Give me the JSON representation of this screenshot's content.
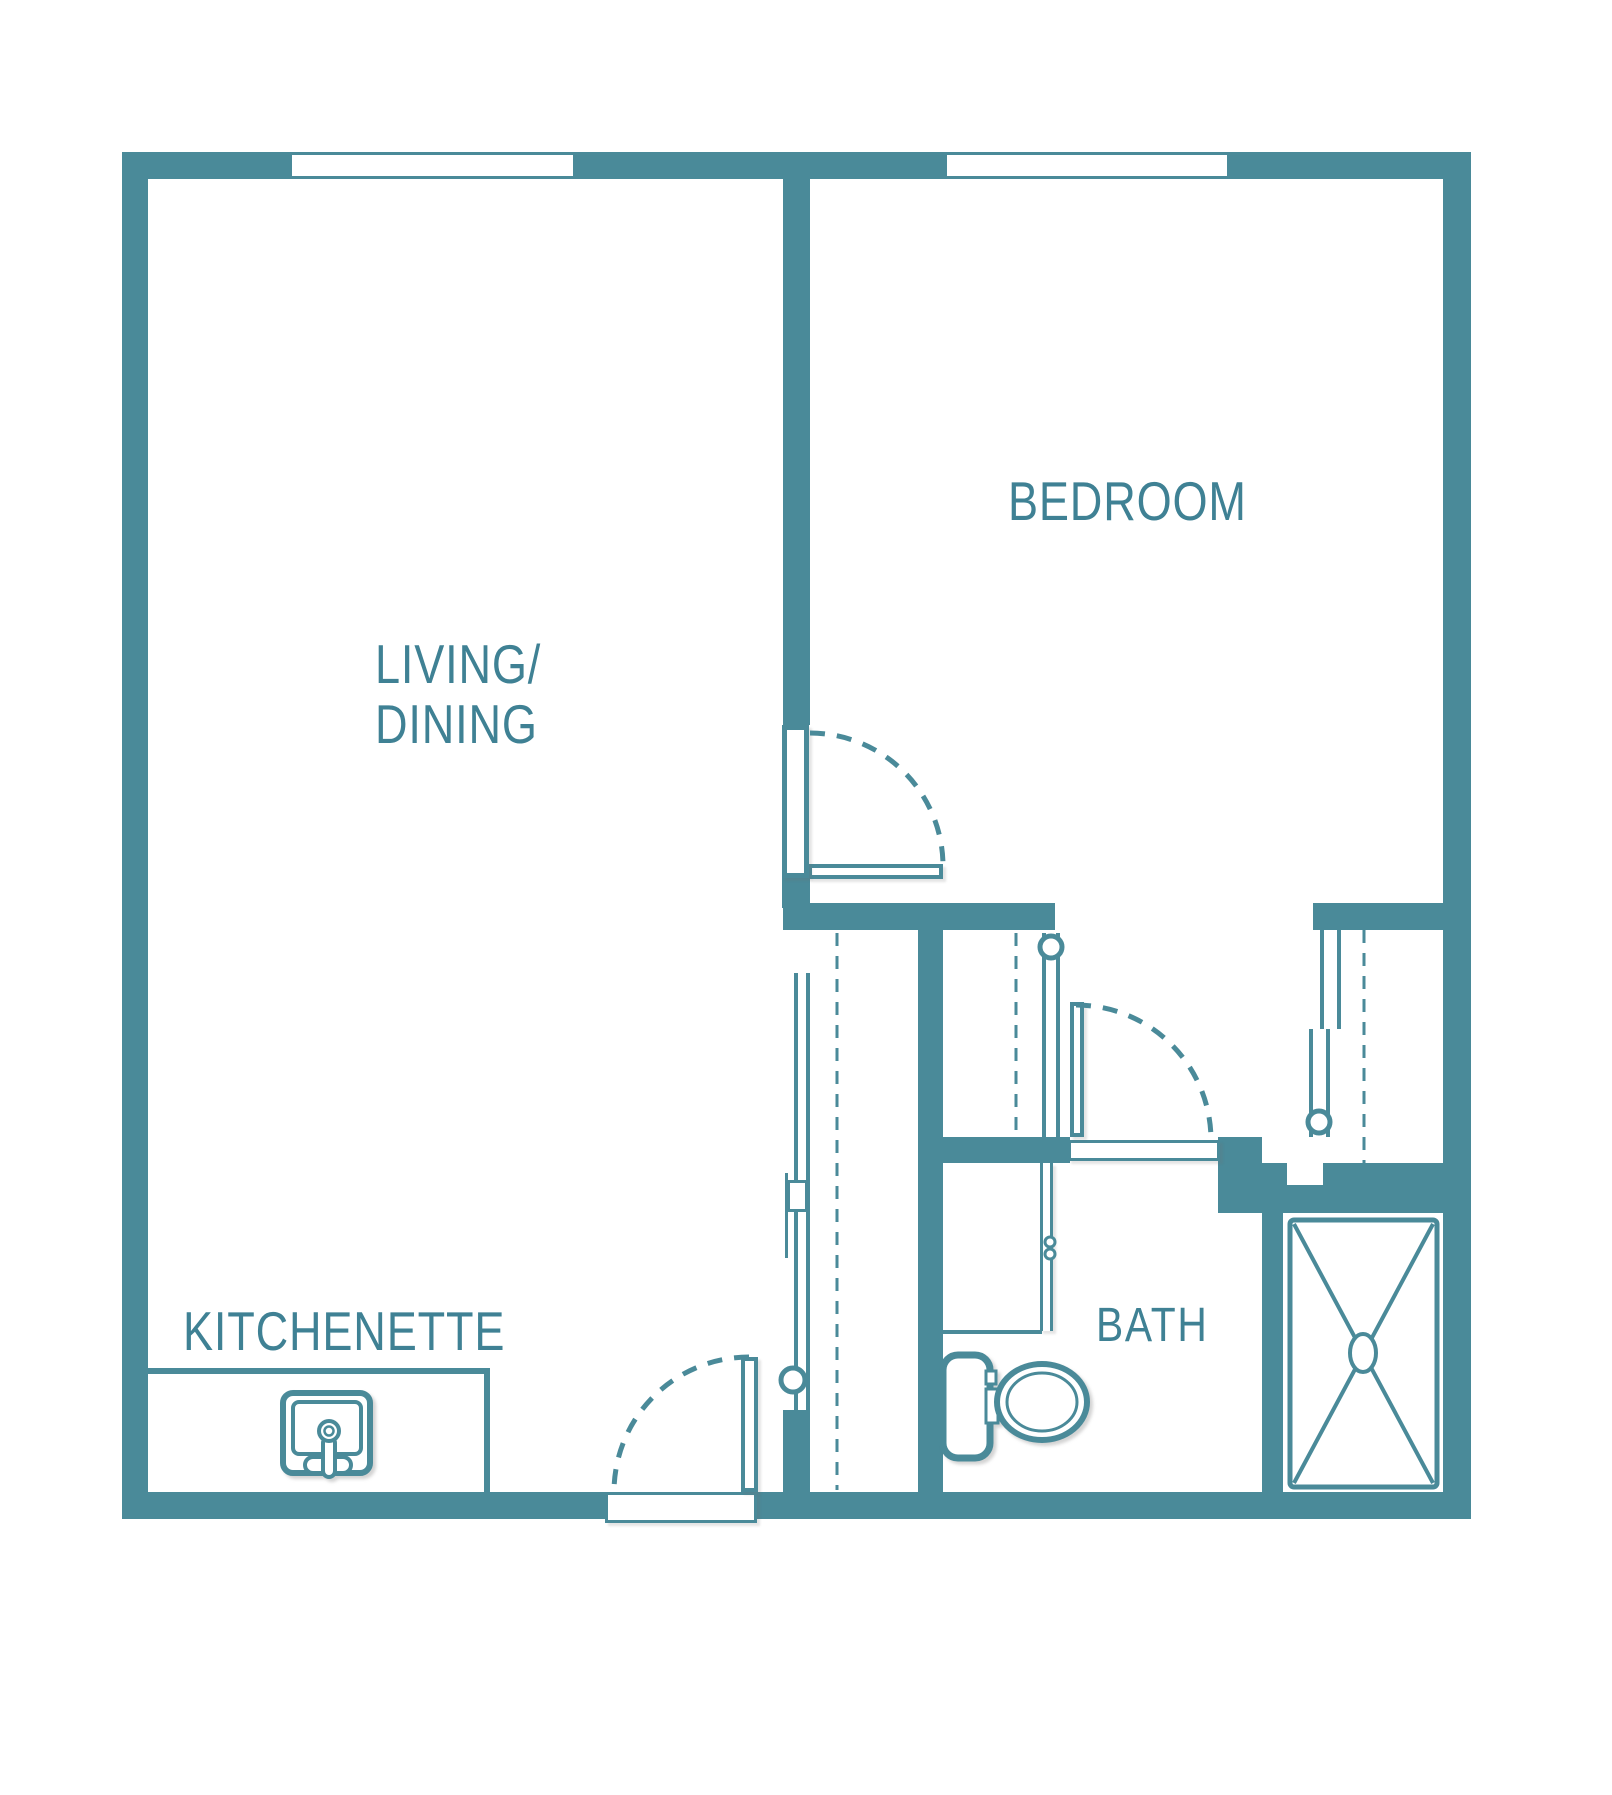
{
  "type": "floor-plan",
  "colors": {
    "wall": "#4A8A99",
    "text": "#3F8194",
    "background": "#FFFFFF"
  },
  "rooms": {
    "living_dining": {
      "label_line1": "LIVING/",
      "label_line2": "DINING"
    },
    "bedroom": {
      "label": "BEDROOM"
    },
    "kitchenette": {
      "label": "KITCHENETTE"
    },
    "bath": {
      "label": "BATH"
    }
  },
  "windows": [
    {
      "name": "living-dining-window",
      "wall": "top"
    },
    {
      "name": "bedroom-window",
      "wall": "top"
    }
  ],
  "doors": [
    {
      "name": "entry-door",
      "type": "swing"
    },
    {
      "name": "bedroom-door",
      "type": "swing"
    },
    {
      "name": "bath-door",
      "type": "swing"
    },
    {
      "name": "hall-closet-door",
      "type": "sliding"
    },
    {
      "name": "dressing-wardrobe-door",
      "type": "sliding"
    },
    {
      "name": "bedroom-closet-door",
      "type": "sliding"
    }
  ],
  "fixtures": [
    {
      "name": "kitchen-sink"
    },
    {
      "name": "toilet"
    },
    {
      "name": "shower"
    },
    {
      "name": "vanity-counter"
    },
    {
      "name": "kitchenette-counter"
    }
  ]
}
